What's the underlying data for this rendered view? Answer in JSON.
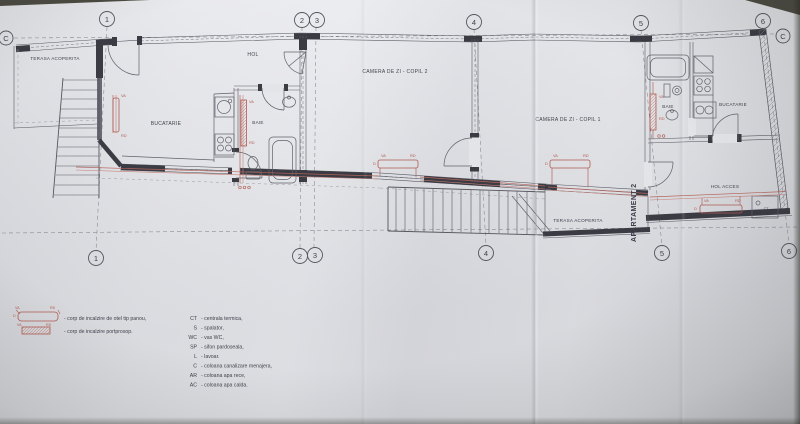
{
  "grid": {
    "top": [
      "1",
      "2",
      "3",
      "4",
      "5",
      "6"
    ],
    "bottom": [
      "1",
      "2",
      "3",
      "4",
      "5",
      "6"
    ],
    "axis_left": "C",
    "axis_right": "C"
  },
  "rooms": {
    "terasa_top": "TERASA ACOPERITA",
    "bucatarie_left": "BUCATARIE",
    "hol": "HOL",
    "baie_mid": "BAIE",
    "copil2": "CAMERA DE ZI - COPIL 2",
    "copil1": "CAMERA DE ZI - COPIL 1",
    "baie_right": "BAIE",
    "bucatarie_right": "BUCATARIE",
    "hol_acces": "HOL ACCES",
    "terasa_bottom": "TERASA ACOPERITA",
    "apartament": "APARTAMENT 2",
    "ct_box": "CT"
  },
  "pipes": {
    "va": "VA",
    "rd": "RD",
    "d": "D"
  },
  "legend": {
    "radiator_panel": "- corp de incalzire de otel tip panou,",
    "radiator_towel": "- corp de incalzire portprosop.",
    "items": [
      {
        "abbr": "CT",
        "desc": "- centrala termica,"
      },
      {
        "abbr": "S",
        "desc": "- spalator,"
      },
      {
        "abbr": "WC",
        "desc": "- vas WC,"
      },
      {
        "abbr": "SP",
        "desc": "- sifon pardoseala,"
      },
      {
        "abbr": "L",
        "desc": "- lavoar."
      },
      {
        "abbr": "C",
        "desc": "- coloana canalizare menajera,"
      },
      {
        "abbr": "AR",
        "desc": "- coloana apa rece,"
      },
      {
        "abbr": "AC",
        "desc": "- coloana apa calda."
      }
    ]
  },
  "colors": {
    "pipe_red": "#b05a50",
    "ink": "#3f3f4a",
    "paper": "#e3e4e8"
  }
}
